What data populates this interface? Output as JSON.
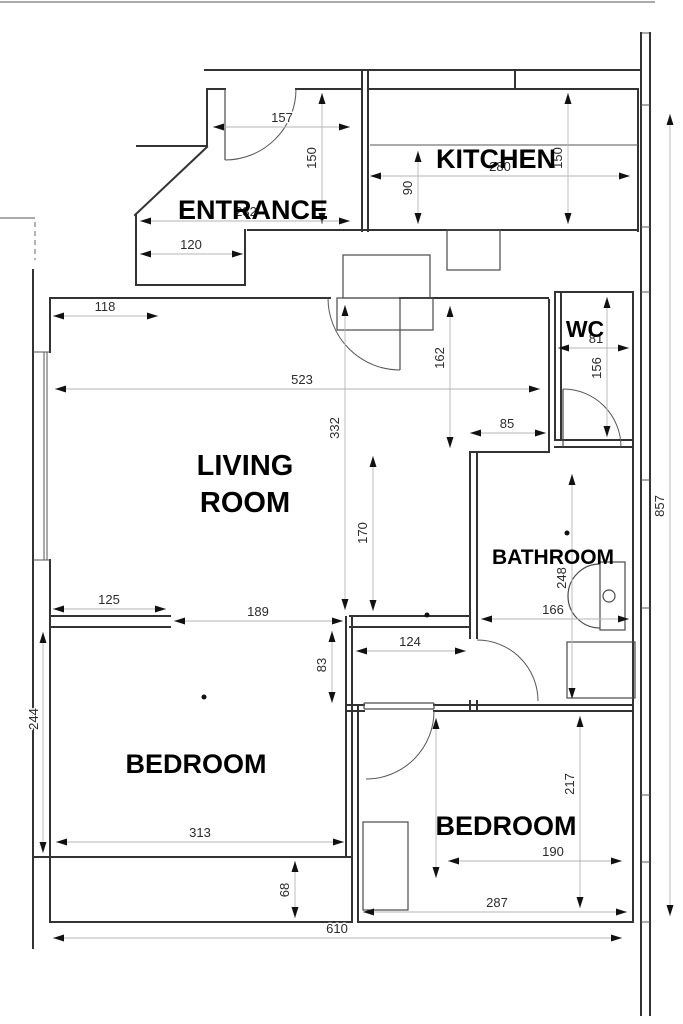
{
  "plan": {
    "type": "floor-plan",
    "rooms": [
      {
        "label": "ENTRANCE"
      },
      {
        "label": "KITCHEN"
      },
      {
        "label": "WC"
      },
      {
        "label": "LIVING ROOM",
        "line1": "LIVING",
        "line2": "ROOM"
      },
      {
        "label": "BATHROOM"
      },
      {
        "label": "BEDROOM"
      },
      {
        "label": "BEDROOM"
      }
    ],
    "dimensions": [
      {
        "value": "157",
        "orientation": "horizontal",
        "location": "entrance-top"
      },
      {
        "value": "150",
        "orientation": "vertical",
        "location": "entrance"
      },
      {
        "value": "280",
        "orientation": "horizontal",
        "location": "kitchen-width"
      },
      {
        "value": "150",
        "orientation": "vertical",
        "location": "kitchen-right"
      },
      {
        "value": "90",
        "orientation": "vertical",
        "location": "kitchen-left"
      },
      {
        "value": "232",
        "orientation": "horizontal",
        "location": "entrance-width"
      },
      {
        "value": "120",
        "orientation": "horizontal",
        "location": "entrance-closet"
      },
      {
        "value": "118",
        "orientation": "horizontal",
        "location": "living-room-top-left"
      },
      {
        "value": "81",
        "orientation": "horizontal",
        "location": "wc-width"
      },
      {
        "value": "156",
        "orientation": "vertical",
        "location": "wc-height"
      },
      {
        "value": "523",
        "orientation": "horizontal",
        "location": "living-room-width"
      },
      {
        "value": "162",
        "orientation": "vertical",
        "location": "corridor-right"
      },
      {
        "value": "332",
        "orientation": "vertical",
        "location": "living-room-height"
      },
      {
        "value": "85",
        "orientation": "horizontal",
        "location": "living-room-right-wall"
      },
      {
        "value": "857",
        "orientation": "vertical",
        "location": "overall-right"
      },
      {
        "value": "170",
        "orientation": "vertical",
        "location": "living-room-lower"
      },
      {
        "value": "248",
        "orientation": "vertical",
        "location": "bathroom-height"
      },
      {
        "value": "125",
        "orientation": "horizontal",
        "location": "partition-left"
      },
      {
        "value": "189",
        "orientation": "horizontal",
        "location": "partition-opening"
      },
      {
        "value": "166",
        "orientation": "horizontal",
        "location": "bathroom-width"
      },
      {
        "value": "124",
        "orientation": "horizontal",
        "location": "hallway-width"
      },
      {
        "value": "83",
        "orientation": "vertical",
        "location": "hallway-height"
      },
      {
        "value": "244",
        "orientation": "vertical",
        "location": "bedroom-left-wall"
      },
      {
        "value": "217",
        "orientation": "vertical",
        "location": "bedroom-right-height"
      },
      {
        "value": "313",
        "orientation": "horizontal",
        "location": "bedroom-left-width"
      },
      {
        "value": "190",
        "orientation": "horizontal",
        "location": "bedroom-right-inner"
      },
      {
        "value": "68",
        "orientation": "vertical",
        "location": "bedroom-left-strip"
      },
      {
        "value": "287",
        "orientation": "horizontal",
        "location": "bedroom-right-width"
      },
      {
        "value": "610",
        "orientation": "horizontal",
        "location": "overall-bottom"
      }
    ],
    "colors": {
      "walls": "#333333",
      "dimension_lines": "#b5b5b5",
      "dimension_text": "#2b2b2b",
      "labels": "#000000",
      "background": "#ffffff"
    }
  }
}
